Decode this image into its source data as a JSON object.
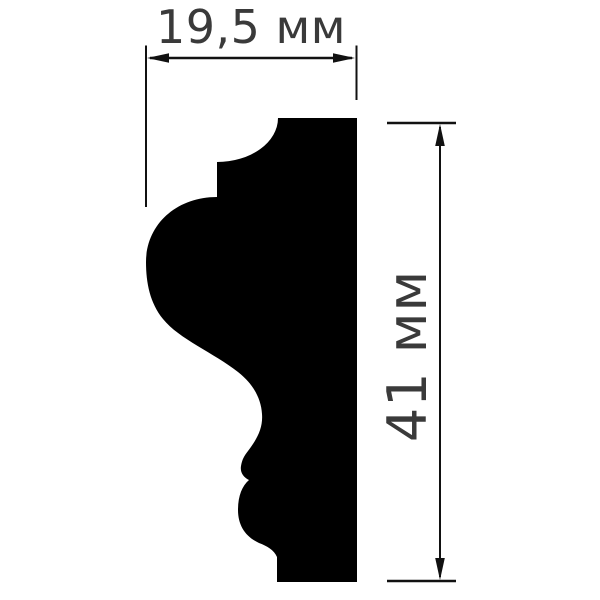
{
  "drawing": {
    "kind": "molding-profile-cross-section",
    "width_dimension": {
      "label": "19,5 мм"
    },
    "height_dimension": {
      "label": "41 мм"
    }
  },
  "colors": {
    "background": "#ffffff",
    "profile_fill": "#000000",
    "dimension_stroke": "#111111",
    "label_text": "#3a3a3a"
  }
}
